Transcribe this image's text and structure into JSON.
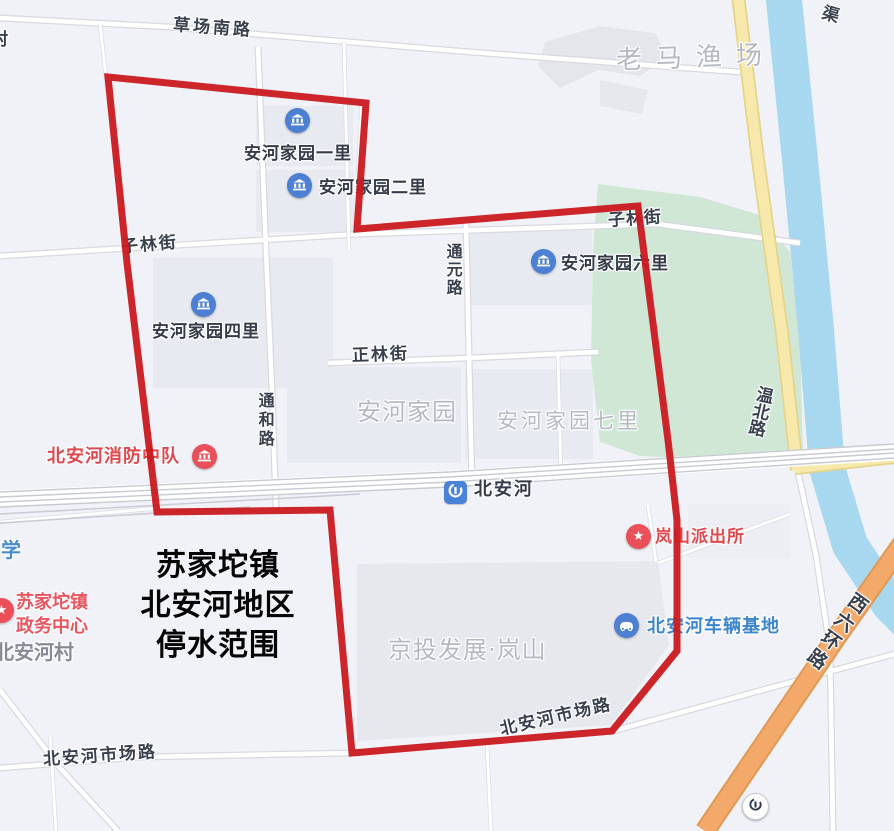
{
  "title_overlay": {
    "lines": [
      "苏家坨镇",
      "北安河地区",
      "停水范围"
    ]
  },
  "roads": {
    "caochang_south": "草场南路",
    "zilin_west": "子林街",
    "zilin_east": "子林街",
    "tongyuan": "通元路",
    "zhenglin": "正林街",
    "tonghe": "通和路",
    "wenbei": "温北路",
    "shichang_west": "北安河市场路",
    "shichang_east": "北安河市场路",
    "xiliuhuan": "西六环路",
    "canal": "渠"
  },
  "areas": {
    "laoma_fishery": "老马渔场",
    "anhe_jiayuan": "安河家园",
    "anhe_jiayuan_qili": "安河家园七里",
    "jingtou_lanshan": "京投发展·岚山",
    "beianhe_village": "北安河村",
    "school_partial": "学",
    "village_partial": "村"
  },
  "pois": {
    "yili": {
      "label": "安河家园一里"
    },
    "erli": {
      "label": "安河家园二里"
    },
    "sili": {
      "label": "安河家园四里"
    },
    "liuli": {
      "label": "安河家园六里"
    },
    "fire": {
      "label": "北安河消防中队"
    },
    "metro": {
      "label": "北安河"
    },
    "police": {
      "label": "岚山派出所"
    },
    "gov": {
      "label_line1": "苏家坨镇",
      "label_line2": "政务中心"
    },
    "vehicle_base": {
      "label": "北安河车辆基地"
    }
  },
  "colors": {
    "boundary_red": "#c9191f",
    "water_blue": "#a8d8ef",
    "park_green": "#d0e7d6",
    "road_yellow": "#f7e9ac",
    "highway_orange": "#f3a969",
    "poi_red": "#ea5059",
    "poi_blue": "#4d7fd2",
    "metro_blue": "#4a82d8",
    "background": "#f1f2f7"
  }
}
